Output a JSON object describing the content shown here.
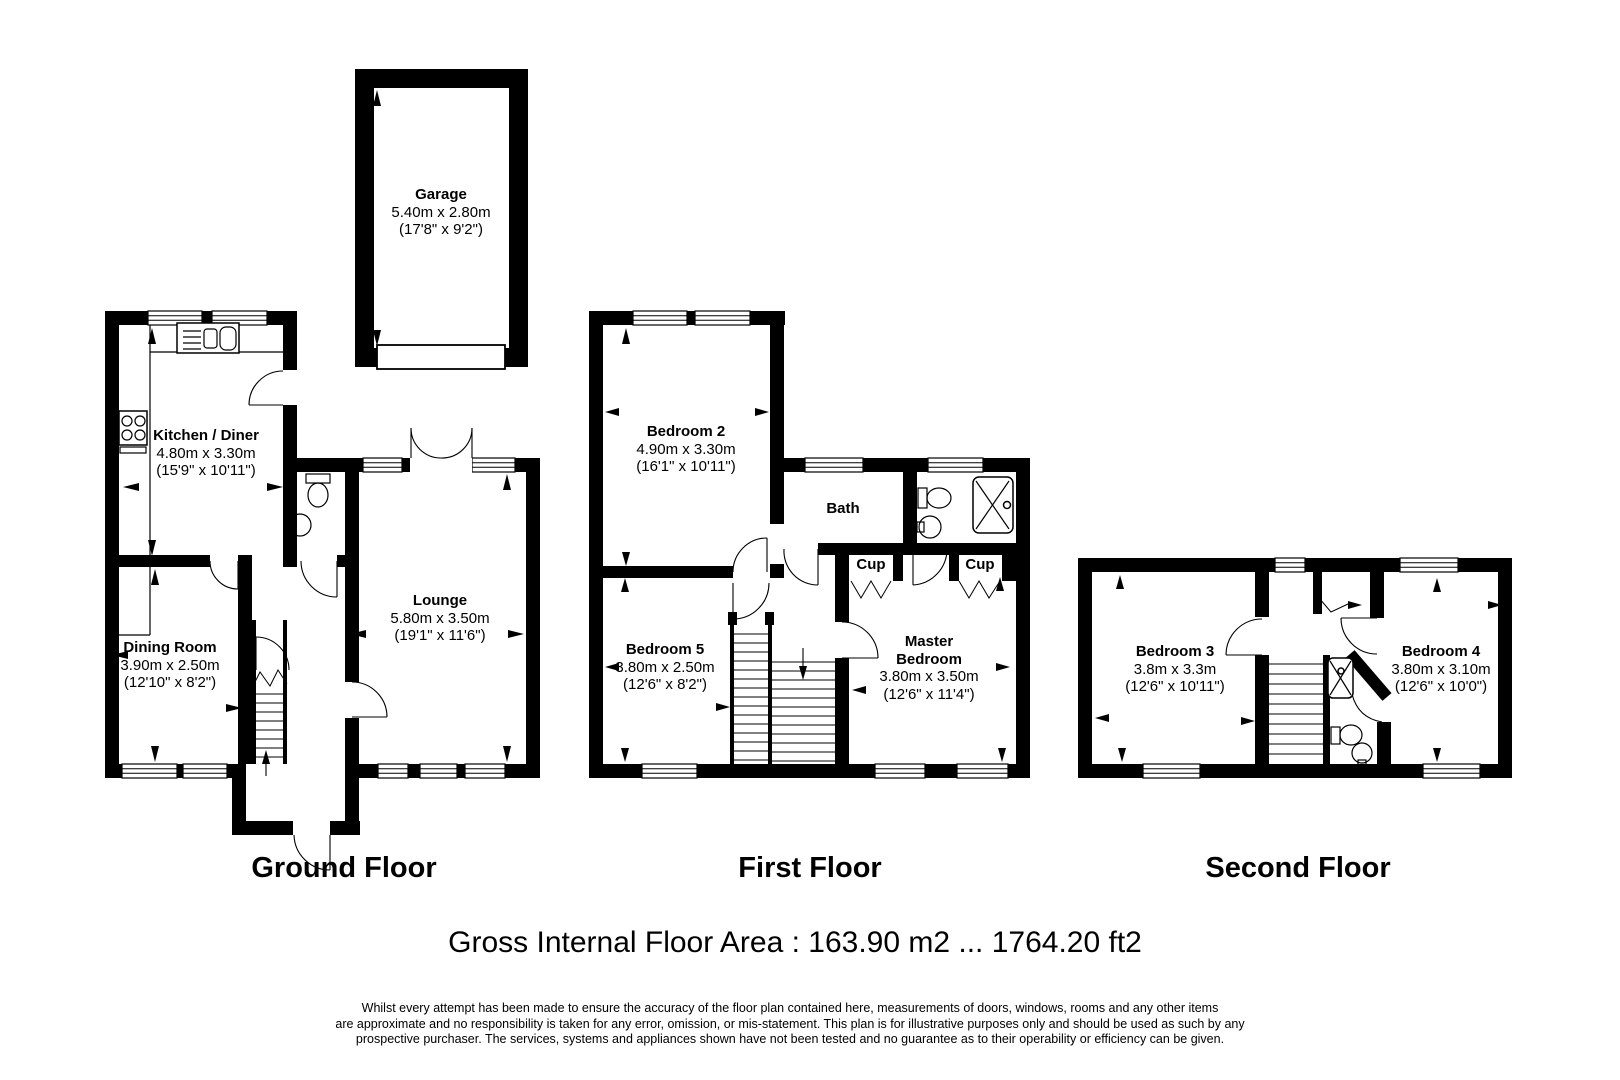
{
  "plan": {
    "background": "#ffffff",
    "wall_color": "#000000",
    "floors": [
      {
        "id": "ground",
        "title": "Ground Floor"
      },
      {
        "id": "first",
        "title": "First Floor"
      },
      {
        "id": "second",
        "title": "Second Floor"
      }
    ]
  },
  "rooms": {
    "garage": {
      "name": "Garage",
      "metric": "5.40m x 2.80m",
      "imperial": "(17'8\" x 9'2\")"
    },
    "kitchen": {
      "name": "Kitchen / Diner",
      "metric": "4.80m x 3.30m",
      "imperial": "(15'9\" x 10'11\")"
    },
    "dining": {
      "name": "Dining Room",
      "metric": "3.90m x 2.50m",
      "imperial": "(12'10\" x 8'2\")"
    },
    "lounge": {
      "name": "Lounge",
      "metric": "5.80m x 3.50m",
      "imperial": "(19'1\" x 11'6\")"
    },
    "bedroom2": {
      "name": "Bedroom 2",
      "metric": "4.90m x 3.30m",
      "imperial": "(16'1\" x 10'11\")"
    },
    "bath": {
      "name": "Bath"
    },
    "cup1": {
      "name": "Cup"
    },
    "cup2": {
      "name": "Cup"
    },
    "bedroom5": {
      "name": "Bedroom 5",
      "metric": "3.80m x 2.50m",
      "imperial": "(12'6\" x 8'2\")"
    },
    "master": {
      "name_line1": "Master",
      "name_line2": "Bedroom",
      "metric": "3.80m x 3.50m",
      "imperial": "(12'6\" x 11'4\")"
    },
    "bedroom3": {
      "name": "Bedroom 3",
      "metric": "3.8m x 3.3m",
      "imperial": "(12'6\" x 10'11\")"
    },
    "bedroom4": {
      "name": "Bedroom 4",
      "metric": "3.80m x 3.10m",
      "imperial": "(12'6\" x 10'0\")"
    }
  },
  "footer": {
    "area": "Gross Internal Floor Area : 163.90 m2 ... 1764.20 ft2",
    "disclaimer_line1": "Whilst every attempt has been made to ensure the accuracy of the floor plan contained here, measurements of doors, windows, rooms and any other items",
    "disclaimer_line2": "are approximate and no responsibility is taken for any error, omission, or mis-statement. This plan is for illustrative purposes only and should be used as such by any",
    "disclaimer_line3": "prospective purchaser. The services, systems and appliances shown have not been tested and no guarantee as to their operability or efficiency can be given."
  }
}
